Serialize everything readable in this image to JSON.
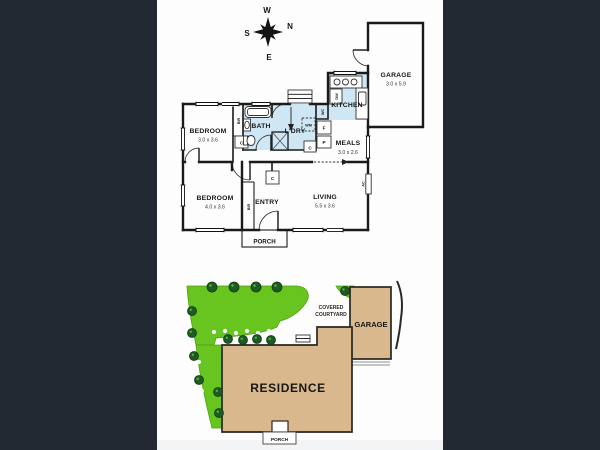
{
  "colors": {
    "backdrop": "#222932",
    "panel": "#fdfdfd",
    "bottom_strip": "#f3f4f6",
    "wet_area": "#cfe7f4",
    "grass": "#68c51f",
    "tree": "#1e5a23",
    "building": "#d9b88d",
    "wall": "#1a1a1a"
  },
  "compass": {
    "north": "N",
    "south": "S",
    "east": "E",
    "west": "W"
  },
  "floor_plan": {
    "bedroom1": {
      "name": "BEDROOM",
      "dims": "3.0 x 3.6"
    },
    "bedroom2": {
      "name": "BEDROOM",
      "dims": "4.0 x 3.6"
    },
    "bath": {
      "name": "BATH"
    },
    "laundry": {
      "name": "L'DRY"
    },
    "kitchen": {
      "name": "KITCHEN"
    },
    "meals": {
      "name": "MEALS",
      "dims": "3.0 x 2.6"
    },
    "living": {
      "name": "LIVING",
      "dims": "5.5 x 3.6"
    },
    "entry": {
      "name": "ENTRY"
    },
    "porch": {
      "name": "PORCH"
    },
    "garage": {
      "name": "GARAGE",
      "dims": "3.0 x 5.9"
    },
    "fixtures": {
      "built_in_robe": "BIR",
      "cupboard": "C",
      "toilet": "WC",
      "washing_machine": "WM",
      "fridge": "F",
      "pantry": "P",
      "dishwasher": "DW",
      "air_conditioner": "AC"
    }
  },
  "site_plan": {
    "residence": "RESIDENCE",
    "garage": "GARAGE",
    "porch": "PORCH",
    "covered_courtyard": {
      "line1": "COVERED",
      "line2": "COURTYARD"
    }
  }
}
